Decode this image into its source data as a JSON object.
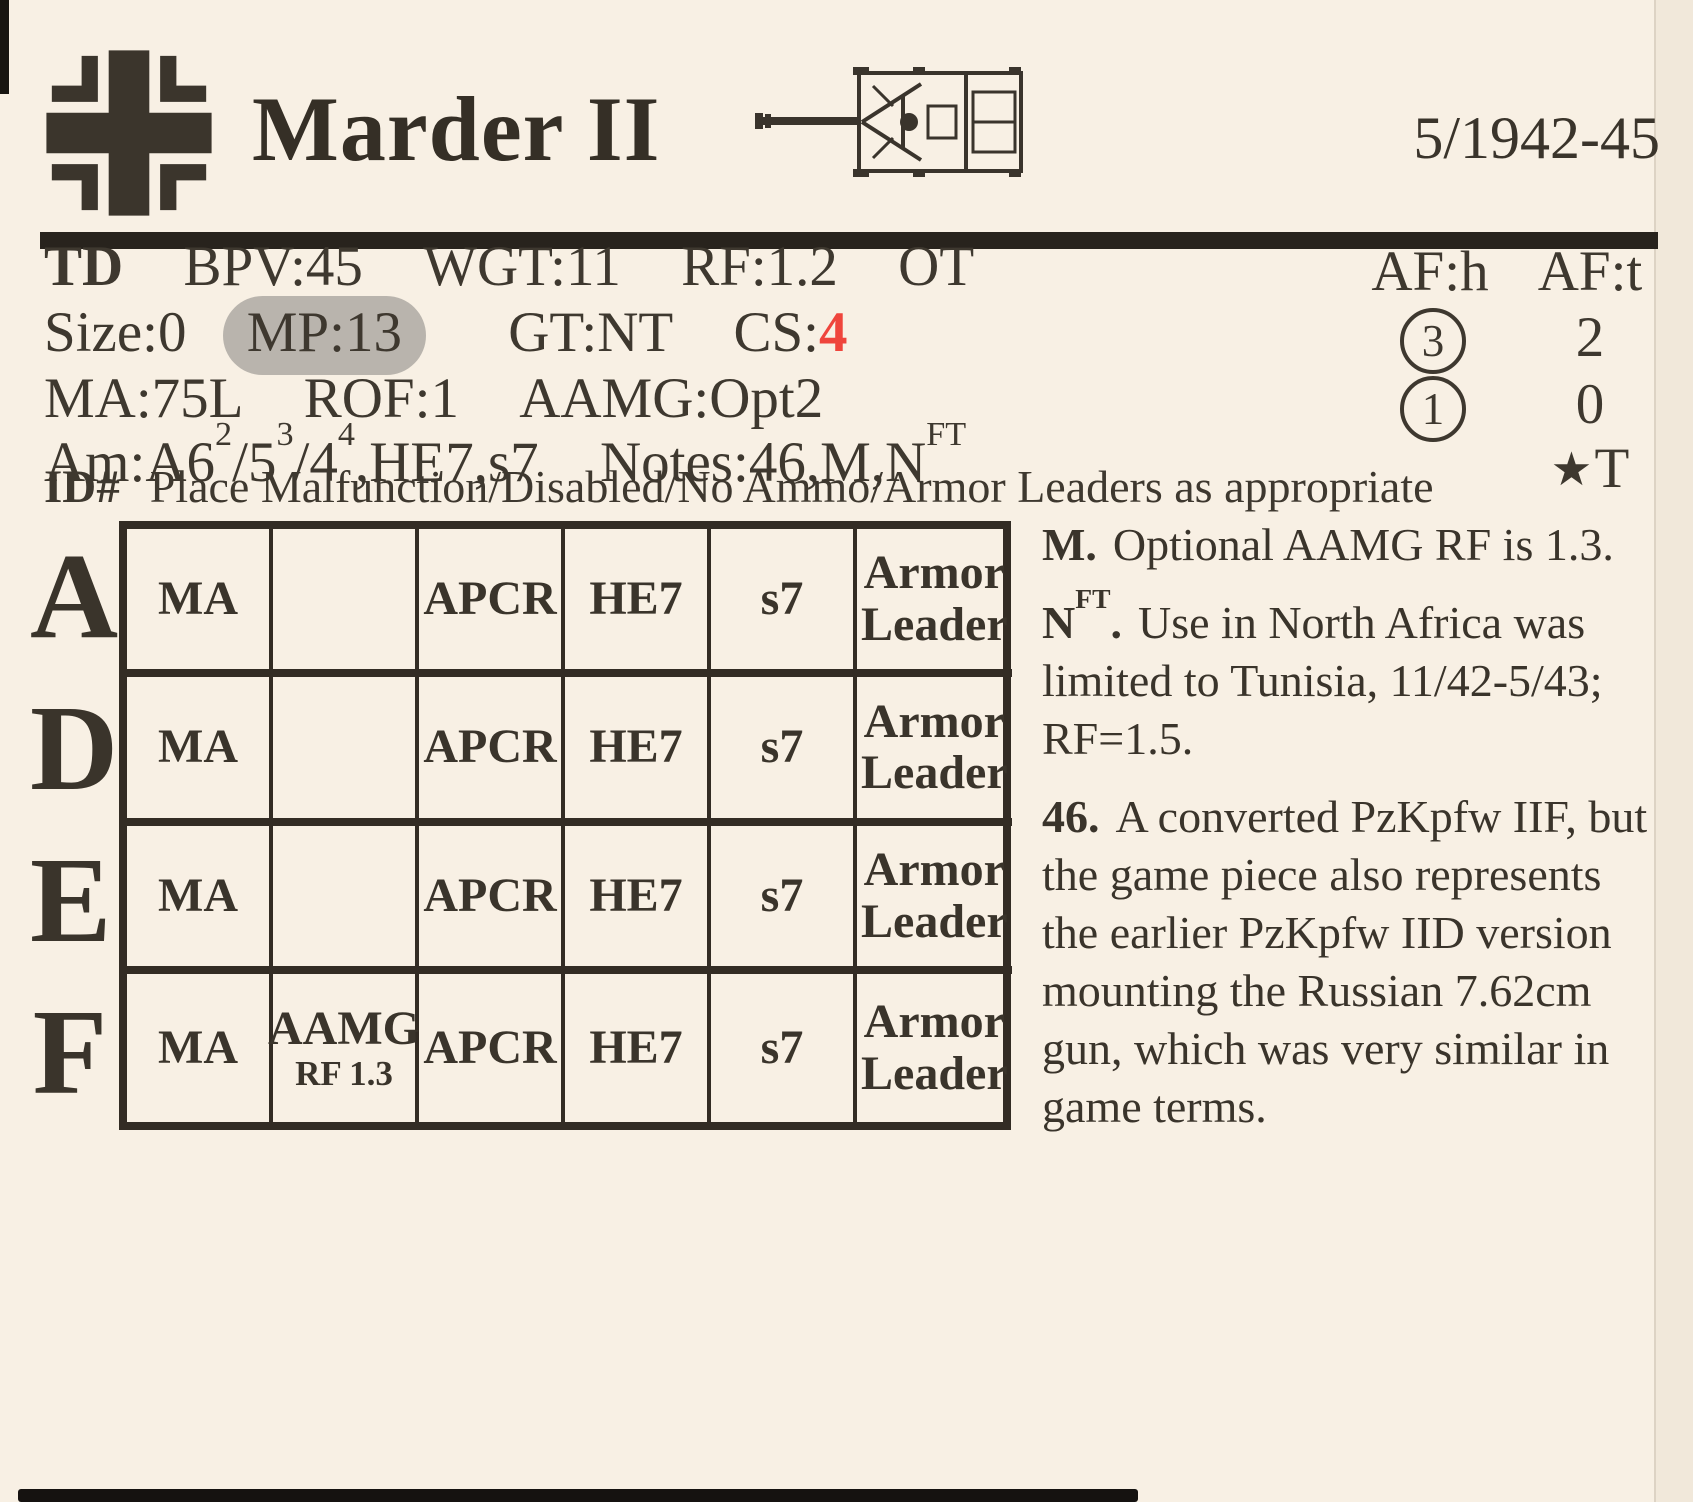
{
  "header": {
    "vehicle_name": "Marder II",
    "date_range": "5/1942-45",
    "nationality_icon": "german-balkenkreuz",
    "vehicle_icon": "tank-destroyer-top-view"
  },
  "stats": {
    "vehicle_class": "TD",
    "bpv": "BPV:45",
    "wgt": "WGT:11",
    "rf": "RF:1.2",
    "ot": "OT",
    "size": "Size:0",
    "mp": "MP:13",
    "gt": "GT:NT",
    "cs_label": "CS:",
    "cs_value": "4",
    "cs_value_color": "#ef453c",
    "mp_highlight_color": "#b9b4ad",
    "ma": "MA:75L",
    "rof": "ROF:1",
    "aamg": "AAMG:Opt2",
    "am_label": "Am:",
    "am_seg1": "A6",
    "am_sup1": "2",
    "am_seg2": "/5",
    "am_sup2": "3",
    "am_seg3": "/4",
    "am_sup3": "4",
    "am_seg4": ",HE7,s7",
    "notes_label": "Notes:",
    "notes_value": "46,M,N",
    "notes_sup": "FT"
  },
  "armor": {
    "head_hull": "AF:h",
    "head_turret": "AF:t",
    "hull_values": [
      "3",
      "1"
    ],
    "hull_values_circled": true,
    "turret_values": [
      "2",
      "0"
    ],
    "star_glyph": "★",
    "star_note": "T"
  },
  "id_line": {
    "id_label": "ID#",
    "instruction": "Place Malfunction/Disabled/No Ammo/Armor Leaders as appropriate"
  },
  "usage_table": {
    "rows": [
      {
        "letter": "A",
        "cells": [
          "MA",
          "",
          "APCR",
          "HE7",
          "s7",
          "Armor Leader"
        ]
      },
      {
        "letter": "D",
        "cells": [
          "MA",
          "",
          "APCR",
          "HE7",
          "s7",
          "Armor Leader"
        ]
      },
      {
        "letter": "E",
        "cells": [
          "MA",
          "",
          "APCR",
          "HE7",
          "s7",
          "Armor Leader"
        ]
      },
      {
        "letter": "F",
        "cells": [
          "MA",
          "",
          "APCR",
          "HE7",
          "s7",
          "Armor Leader"
        ],
        "aamg_main": "AAMG",
        "aamg_sub": "RF 1.3"
      }
    ]
  },
  "vehicle_notes": [
    {
      "label": "M",
      "label_sup": "",
      "label_period": ".",
      "body": "Optional AAMG RF is 1.3."
    },
    {
      "label": "N",
      "label_sup": "FT",
      "label_period": ".",
      "body": "Use in North Africa was limited to Tunisia, 11/42-5/43; RF=1.5."
    },
    {
      "label": "46",
      "label_sup": "",
      "label_period": ".",
      "body": "A converted PzKpfw IIF, but the game piece also represents the earlier PzKpfw IID version mounting the Russian 7.62cm gun, which was very similar in game terms."
    }
  ]
}
